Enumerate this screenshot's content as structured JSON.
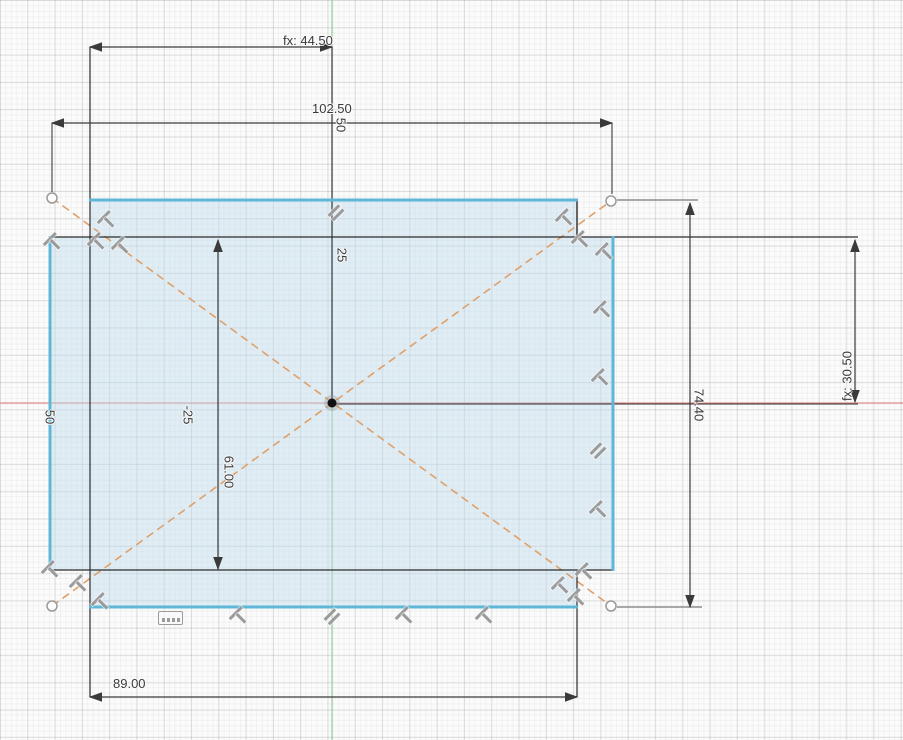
{
  "app": {
    "view": "cad-sketch-canvas"
  },
  "sketch": {
    "dimensions": {
      "fx_horizontal": "fx: 44.50",
      "overall_width": "102.50",
      "offset_top_50": "50",
      "offset_25": "25",
      "offset_neg_25": "-25",
      "offset_left_50": "50",
      "inner_height": "61.00",
      "overall_height": "74.40",
      "fx_vertical": "fx: 30.50",
      "bottom_width": "89.00"
    },
    "icons": {
      "parallel": "parallel-constraint-icon",
      "perpendicular": "perpendicular-constraint-icon",
      "pattern": "rectangular-pattern-icon",
      "origin": "origin-point",
      "construction_endpoint": "construction-endpoint"
    },
    "colors": {
      "profile_fill": "#bfdcee",
      "profile_edge": "#5fb7d8",
      "construction_line": "#dfa06a",
      "axis_x": "#e08c8c",
      "axis_y": "#94cd94",
      "dimension": "#3a3a3a",
      "constraint_icon": "#9b9b9b"
    }
  }
}
